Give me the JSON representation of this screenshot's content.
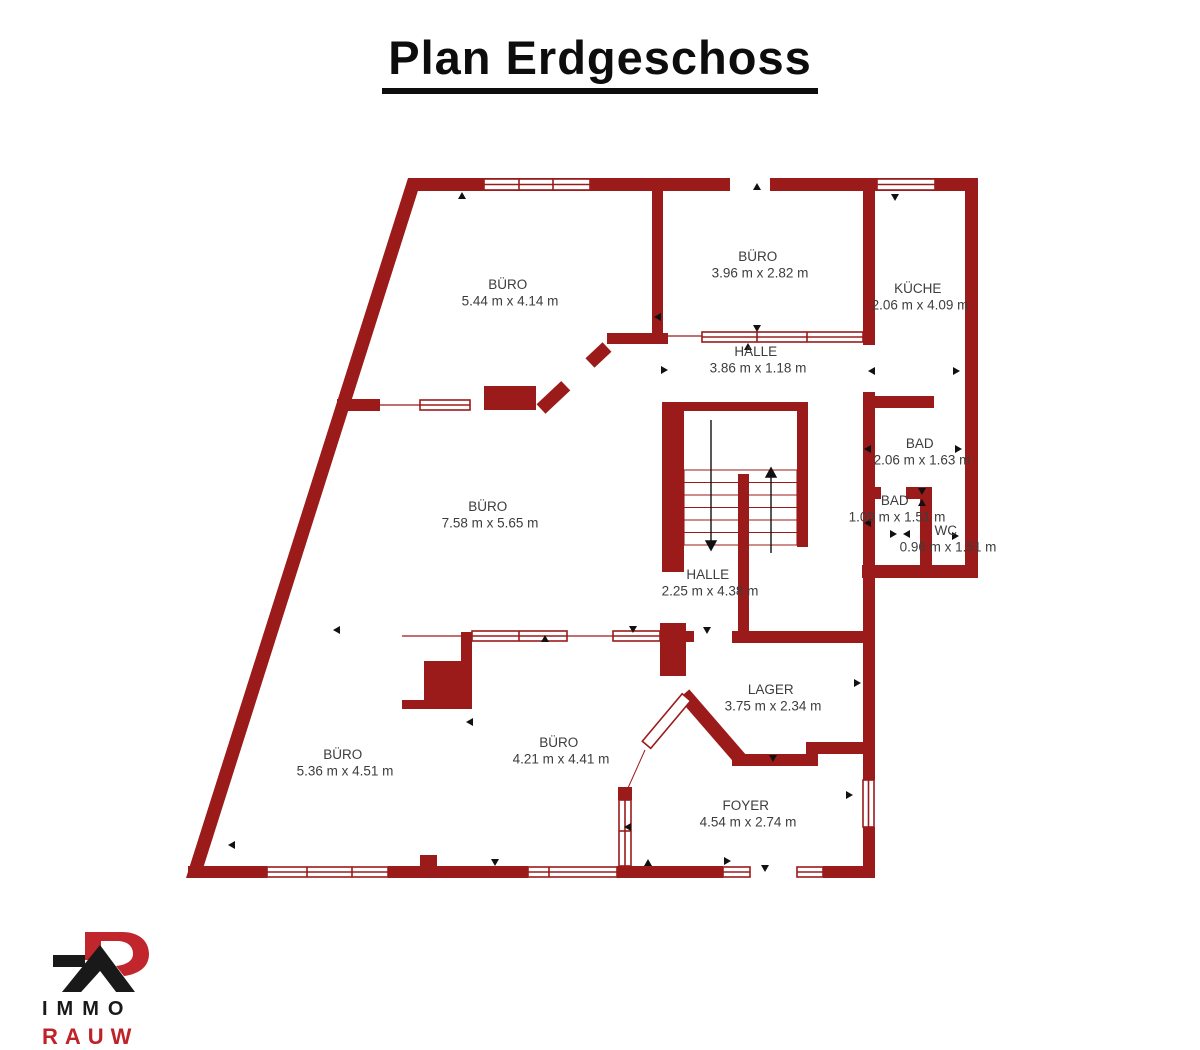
{
  "page": {
    "title": "Plan Erdgeschoss"
  },
  "palette": {
    "wall_color": "#9b1b1b",
    "label_color": "#3d3d3d",
    "logo_red": "#c0262c",
    "logo_black": "#191919"
  },
  "plan": {
    "rooms": [
      {
        "id": "buero-top-left",
        "name": "BÜRO",
        "dims": "5.44 m x 4.14 m"
      },
      {
        "id": "buero-top-mid",
        "name": "BÜRO",
        "dims": "3.96 m x 2.82 m"
      },
      {
        "id": "kueche",
        "name": "KÜCHE",
        "dims": "2.06 m x 4.09 m"
      },
      {
        "id": "halle-top",
        "name": "HALLE",
        "dims": "3.86 m x 1.18 m"
      },
      {
        "id": "bad-large",
        "name": "BAD",
        "dims": "2.06 m x 1.63 m"
      },
      {
        "id": "bad-small",
        "name": "BAD",
        "dims": "1.00 m x 1.51 m"
      },
      {
        "id": "wc",
        "name": "WC",
        "dims": "0.96 m x 1.51 m"
      },
      {
        "id": "buero-center",
        "name": "BÜRO",
        "dims": "7.58 m x 5.65 m"
      },
      {
        "id": "halle-center",
        "name": "HALLE",
        "dims": "2.25 m x 4.38 m"
      },
      {
        "id": "lager",
        "name": "LAGER",
        "dims": "3.75 m x 2.34 m"
      },
      {
        "id": "buero-bottom-left",
        "name": "BÜRO",
        "dims": "5.36 m x 4.51 m"
      },
      {
        "id": "buero-bottom-mid",
        "name": "BÜRO",
        "dims": "4.21 m x 4.41 m"
      },
      {
        "id": "foyer",
        "name": "FOYER",
        "dims": "4.54 m x 2.74 m"
      }
    ]
  },
  "logo": {
    "line1": "IMMO",
    "line2": "RAUW"
  }
}
